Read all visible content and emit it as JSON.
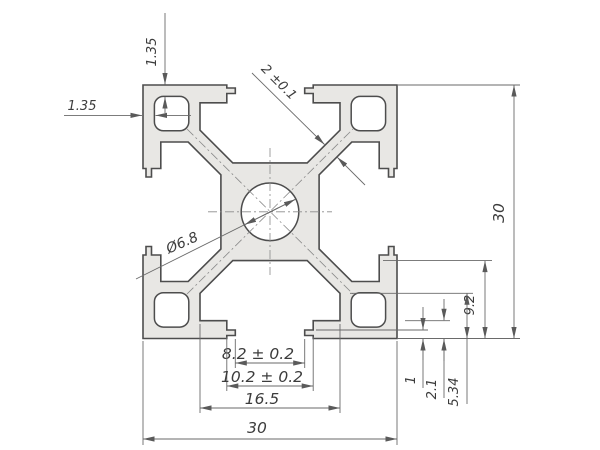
{
  "drawing": {
    "title": "30x30 aluminium T-slot extrusion profile cross-section",
    "dimensions": {
      "wall_top": "1.35",
      "wall_left": "1.35",
      "web_thickness": "2 ±0.1",
      "center_hole": "Ø6.8",
      "overall_height": "30",
      "overall_width": "30",
      "slot_depth": "9.2",
      "slot_side_depth": "5.34",
      "lip_depth": "2.1",
      "lip_step": "1",
      "slot_opening": "8.2 ± 0.2",
      "slot_undercut": "10.2 ± 0.2",
      "slot_inner_width": "16.5"
    },
    "colors": {
      "profile_fill": "#e8e7e4",
      "outline": "#4d4d4d",
      "dimension_line": "#6a6a6a",
      "text": "#3c3c3c",
      "background": "#ffffff"
    }
  }
}
